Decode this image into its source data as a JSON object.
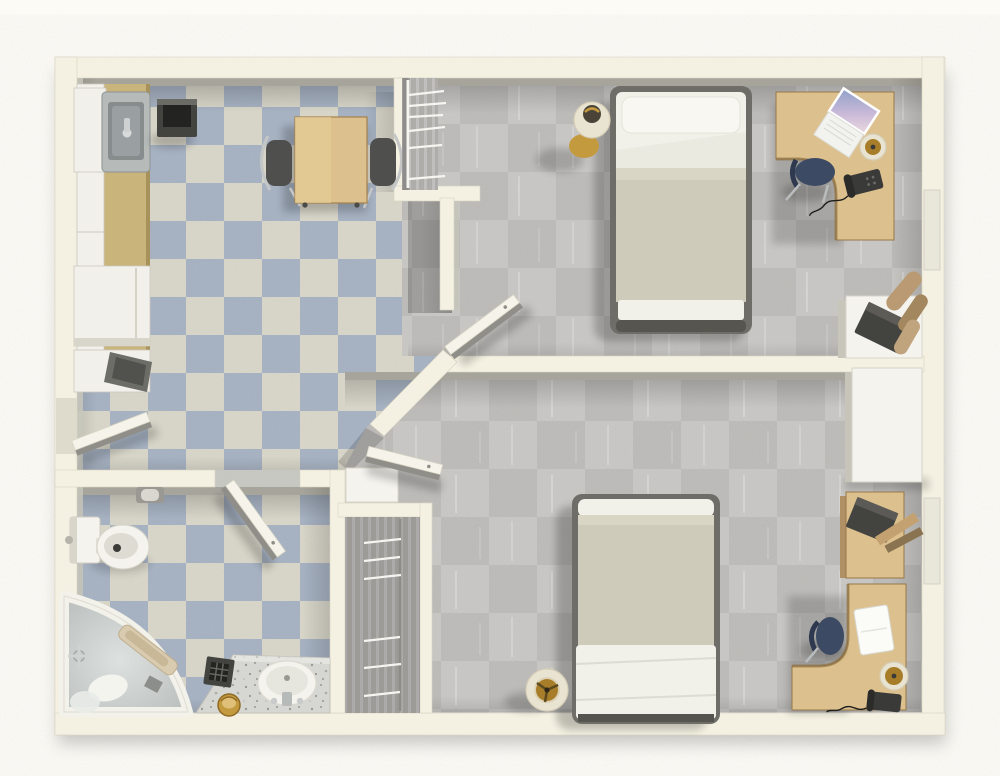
{
  "scene": {
    "kind": "3d-floor-plan-render",
    "view": "top-down",
    "description": "Top-down 3D rendering of a one-story apartment floor plan with a kitchen, a bathroom and two furnished bedrooms",
    "canvas": {
      "width": 1000,
      "height": 776
    }
  },
  "colors": {
    "page": "#fcfbf6",
    "wall": "#f4f1e2",
    "wallEdge": "#d7d4c3",
    "wallFace": "#a7a59b",
    "tileLight": "#d9d6c9",
    "tileBlue": "#a5b1c2",
    "carpetBase": "#bcbbb8",
    "carpetAlt": "#c8c7c4",
    "closetFloor": "#aeadaa",
    "wood": "#dcc18e",
    "woodEdge": "#97784a",
    "counterTan": "#c9b47c",
    "blanket": "#cfcbba",
    "sheet": "#f1f0e9",
    "bedFrame": "#6e6d68",
    "navyChair": "#3d4a63",
    "steel": "#b6bab9",
    "sinkBasin": "#878c8d",
    "gold": "#a87d2a",
    "goldBright": "#c49a3f",
    "lampShade": "#e9e3d1",
    "fixtureWhite": "#f4f3ee",
    "graniteBase": "#d6d7d2",
    "darkAppliance": "#434340",
    "appliance": "#f1f0ea",
    "doorTop": "#f6f4ea",
    "doorFace": "#8f8e88",
    "windowGlass": "#e9e7da"
  },
  "rooms": [
    {
      "id": "kitchen",
      "name": "Kitchen",
      "position": "top-left",
      "floor": "blue and cream checkerboard tile",
      "furniture": [
        "counter with white cabinets",
        "stainless steel sink",
        "dark cooktop appliance",
        "refrigerator",
        "open lower cabinet",
        "wooden dining table",
        "two metal-frame chairs",
        "open entry door"
      ]
    },
    {
      "id": "bedroom-1",
      "name": "Bedroom 1",
      "position": "top-right",
      "floor": "gray carpet",
      "furniture": [
        "double bed with beige blanket",
        "bedside lamp",
        "corner wooden desk",
        "laptop",
        "desk lamp",
        "telephone",
        "desk chair",
        "open closet with hangers",
        "white side table with printer",
        "rolled towels",
        "window",
        "open door"
      ]
    },
    {
      "id": "bathroom",
      "name": "Bathroom",
      "position": "bottom-left",
      "floor": "blue and cream checkerboard tile",
      "furniture": [
        "toilet",
        "toilet-paper holder",
        "corner bathtub with chrome faucet",
        "granite vanity with oval sink",
        "waste grate box",
        "brass bin",
        "open door"
      ]
    },
    {
      "id": "bedroom-2",
      "name": "Bedroom 2",
      "position": "bottom-right",
      "floor": "gray carpet",
      "furniture": [
        "double bed with beige blanket",
        "floor lamp",
        "corner wooden desk",
        "laptop",
        "desk lamp",
        "telephone",
        "desk chair",
        "closet with hangers",
        "white wardrobe",
        "wooden shelf with speaker and planks",
        "window",
        "open door"
      ]
    }
  ]
}
